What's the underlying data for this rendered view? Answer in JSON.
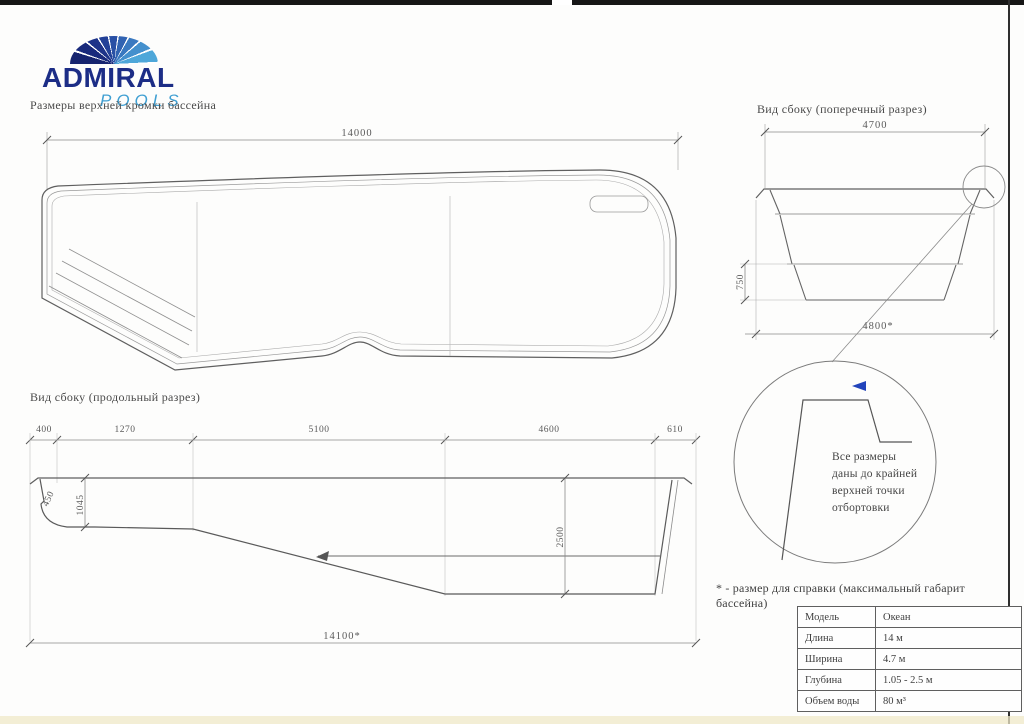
{
  "colors": {
    "brand_navy": "#1c2d86",
    "brand_blue": "#3f9fd2",
    "line": "#666666",
    "text": "#4a4a4a",
    "frame": "#1a1a1a"
  },
  "logo": {
    "brand": "ADMIRAL",
    "sub": "POOLS"
  },
  "headings": {
    "plan": "Размеры верхней кромки бассейна",
    "cross_section": "Вид сбоку (поперечный разрез)",
    "long_section": "Вид сбоку (продольный разрез)"
  },
  "plan_view": {
    "length_dim": "14000"
  },
  "cross_section": {
    "top_dim": "4700",
    "step_dim": "750",
    "bottom_dim": "4800*"
  },
  "long_section": {
    "top_dims": [
      "400",
      "1270",
      "5100",
      "4600",
      "610"
    ],
    "step_dim": "450",
    "shallow_depth_dim": "1045",
    "deep_depth_dim": "2500",
    "bottom_dim": "14100*"
  },
  "detail_note": {
    "lines": [
      "Все размеры",
      "даны до крайней",
      "верхней точки",
      "отбортовки"
    ]
  },
  "footnote": "* - размер для справки (максимальный габарит бассейна)",
  "spec_table": {
    "rows": [
      {
        "label": "Модель",
        "value": "Океан"
      },
      {
        "label": "Длина",
        "value": "14 м"
      },
      {
        "label": "Ширина",
        "value": "4.7 м"
      },
      {
        "label": "Глубина",
        "value": "1.05 - 2.5 м"
      },
      {
        "label": "Объем воды",
        "value": "80 м³"
      }
    ]
  }
}
